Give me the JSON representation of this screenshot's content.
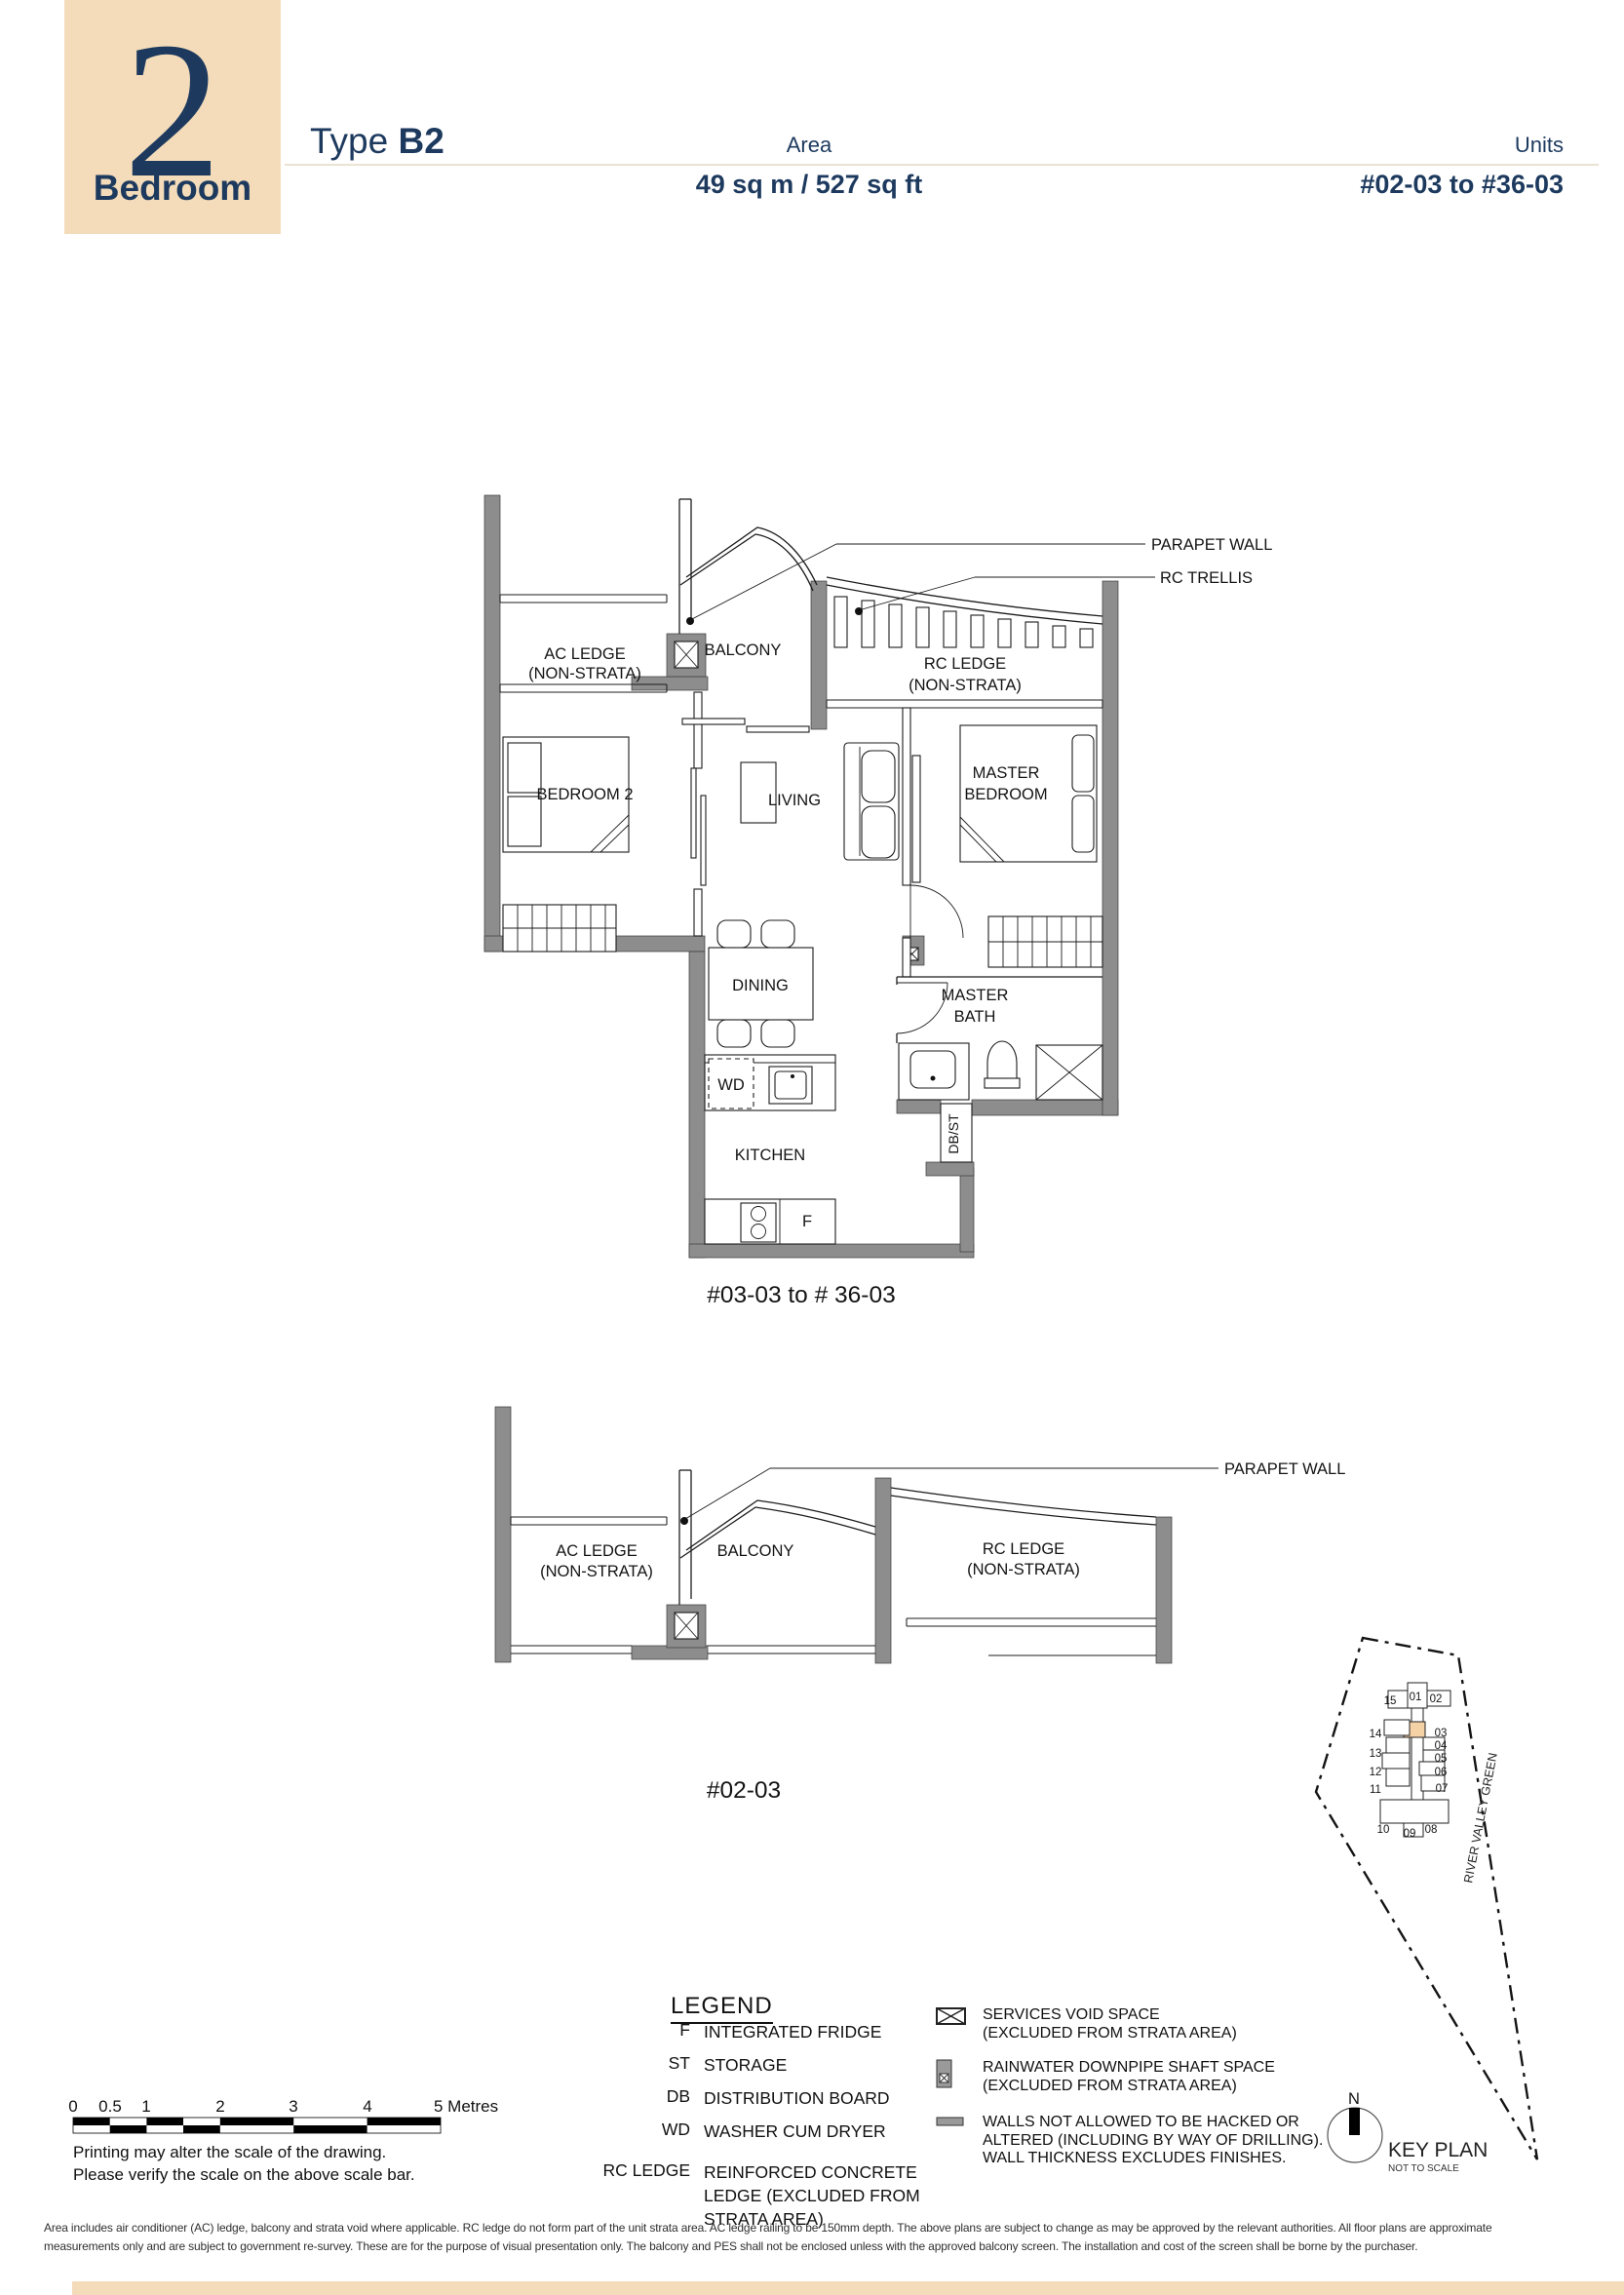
{
  "header": {
    "number": "2",
    "label": "Bedroom",
    "type_label": "Type",
    "type_value": "B2",
    "area_label": "Area",
    "area_value": "49 sq m / 527 sq ft",
    "units_label": "Units",
    "units_value": "#02-03 to #36-03"
  },
  "plan_main": {
    "caption": "#03-03 to # 36-03",
    "labels": {
      "parapet_wall": "PARAPET WALL",
      "rc_trellis": "RC TRELLIS",
      "ac_ledge": "AC LEDGE",
      "non_strata": "(NON-STRATA)",
      "balcony": "BALCONY",
      "rc_ledge": "RC LEDGE",
      "bedroom2": "BEDROOM 2",
      "living": "LIVING",
      "master_line1": "MASTER",
      "master_line2": "BEDROOM",
      "dining": "DINING",
      "bath_line1": "MASTER",
      "bath_line2": "BATH",
      "kitchen": "KITCHEN",
      "wd": "WD",
      "fridge": "F",
      "db_st": "DB/ST"
    }
  },
  "plan_section": {
    "caption": "#02-03",
    "labels": {
      "parapet_wall": "PARAPET WALL",
      "ac_ledge": "AC LEDGE",
      "non_strata": "(NON-STRATA)",
      "balcony": "BALCONY",
      "rc_ledge": "RC LEDGE"
    }
  },
  "key_plan": {
    "title": "KEY PLAN",
    "subtitle": "NOT TO SCALE",
    "north": "N",
    "street": "RIVER VALLEY GREEN",
    "highlighted_unit": "03",
    "units": {
      "u15": "15",
      "u01": "01",
      "u02": "02",
      "u03": "03",
      "u04": "04",
      "u05": "05",
      "u06": "06",
      "u07": "07",
      "u14": "14",
      "u13": "13",
      "u12": "12",
      "u11": "11",
      "u10": "10",
      "u09": "09",
      "u08": "08"
    }
  },
  "legend": {
    "title": "LEGEND",
    "items": [
      {
        "abbr": "F",
        "lines": [
          "INTEGRATED FRIDGE"
        ]
      },
      {
        "abbr": "ST",
        "lines": [
          "STORAGE"
        ]
      },
      {
        "abbr": "DB",
        "lines": [
          "DISTRIBUTION BOARD"
        ]
      },
      {
        "abbr": "WD",
        "lines": [
          "WASHER CUM DRYER"
        ]
      },
      {
        "abbr": "RC LEDGE",
        "lines": [
          "REINFORCED CONCRETE",
          "LEDGE (EXCLUDED FROM",
          "STRATA AREA)"
        ]
      }
    ],
    "symbols": [
      {
        "name": "services-void",
        "lines": [
          "SERVICES VOID SPACE",
          "(EXCLUDED FROM STRATA AREA)"
        ]
      },
      {
        "name": "rainwater-downpipe",
        "lines": [
          "RAINWATER DOWNPIPE SHAFT SPACE",
          "(EXCLUDED FROM STRATA AREA)"
        ]
      },
      {
        "name": "no-hack-walls",
        "lines": [
          "WALLS NOT ALLOWED TO BE HACKED OR",
          "ALTERED (INCLUDING BY WAY OF DRILLING).",
          "WALL THICKNESS EXCLUDES FINISHES."
        ]
      }
    ]
  },
  "scale_bar": {
    "labels": [
      "0",
      "0.5",
      "1",
      "2",
      "3",
      "4"
    ],
    "end_label": "5 Metres",
    "note1": "Printing may alter the scale of the drawing.",
    "note2": "Please verify the scale on the above scale bar."
  },
  "disclaimer": {
    "line1": "Area includes air conditioner (AC) ledge, balcony and strata void where applicable. RC ledge do not form part of the unit strata area. AC ledge railing to be 150mm depth. The above plans are subject to change as may be approved by the relevant authorities. All floor plans are approximate",
    "line2": "measurements only and are subject to government re-survey. These are for the purpose of visual presentation only. The balcony and PES shall not be enclosed unless with the approved balcony screen. The installation and cost of the screen shall be borne by the purchaser."
  },
  "colors": {
    "navy": "#1d3a5e",
    "beige": "#f4dcba",
    "wall": "#8d8d8d",
    "highlight": "#f5d2a6",
    "rule": "#eae3d2"
  }
}
